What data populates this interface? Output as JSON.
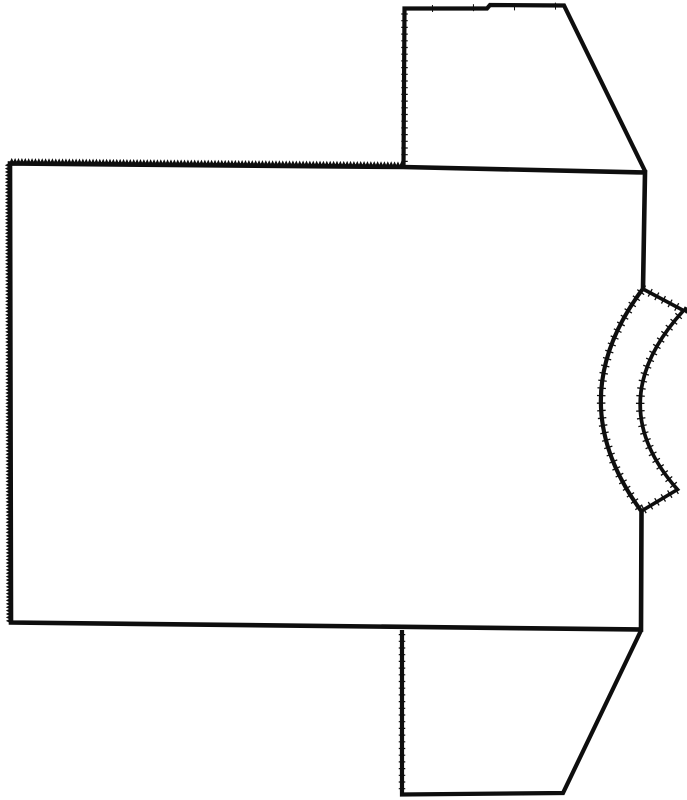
{
  "canvas": {
    "width": 687,
    "height": 800,
    "background": "#ffffff",
    "ink": "#0e0e0e"
  },
  "drawing": {
    "subject": "flat line drawing of a short-sleeve t-shirt pattern, collar at right side",
    "draw_order": [
      "body",
      "sleeve_top",
      "sleeve_bottom",
      "neckband"
    ],
    "pieces": {
      "body": {
        "name": "body-panel",
        "path": "M 10 163.5 L 403 167 L 645 172.5 L 643 289 Q 560 400 641.5 511 L 641 629.5 L 11 622.5 Z",
        "fill": "#ffffff",
        "stroke_width": 4.6
      },
      "sleeve_top": {
        "name": "top-sleeve",
        "path": "M 403.5 168 L 404.5 8.5 L 487 8.5 L 490 5 L 564 5.5 L 645.5 172",
        "fill": "none",
        "stroke_width": 4.2
      },
      "sleeve_bottom": {
        "name": "bottom-sleeve",
        "path": "M 402 630 L 402 794.5 L 563 793 L 641 630.5",
        "fill": "none",
        "stroke_width": 4.2
      },
      "neckband": {
        "name": "neckband",
        "path": "M 643 289 L 683.5 310.5 Q 600 402 677.5 489.5 L 641.5 511 Q 560 400 643 289 Z",
        "fill": "#ffffff",
        "stroke_width": 3.6,
        "texture_width": 8.5,
        "texture_dash": "1.3 6.2"
      }
    },
    "serrated_edges": [
      {
        "name": "body-top-edge-serration",
        "x1": 10,
        "y1": 163.5,
        "x2": 403,
        "y2": 167,
        "pitch": 3.4,
        "amp": 3.6,
        "stroke_width": 1.7
      },
      {
        "name": "body-left-edge-serration",
        "x1": 11,
        "y1": 622.5,
        "x2": 10,
        "y2": 163.5,
        "pitch": 3.4,
        "amp": 3.3,
        "stroke_width": 1.7
      }
    ],
    "rough_edges": [
      {
        "name": "top-sleeve-left-edge-texture",
        "path": "M 404.5 162 L 404.5 12",
        "width": 6.5,
        "dash": "1.2 5.5"
      },
      {
        "name": "bottom-sleeve-left-edge-texture",
        "path": "M 402 634 L 402 791",
        "width": 6.5,
        "dash": "1.2 5.5"
      },
      {
        "name": "top-sleeve-top-edge-ticks",
        "path": "M 432 8.5 L 560 6",
        "width": 7,
        "dash": "1 40"
      }
    ]
  }
}
